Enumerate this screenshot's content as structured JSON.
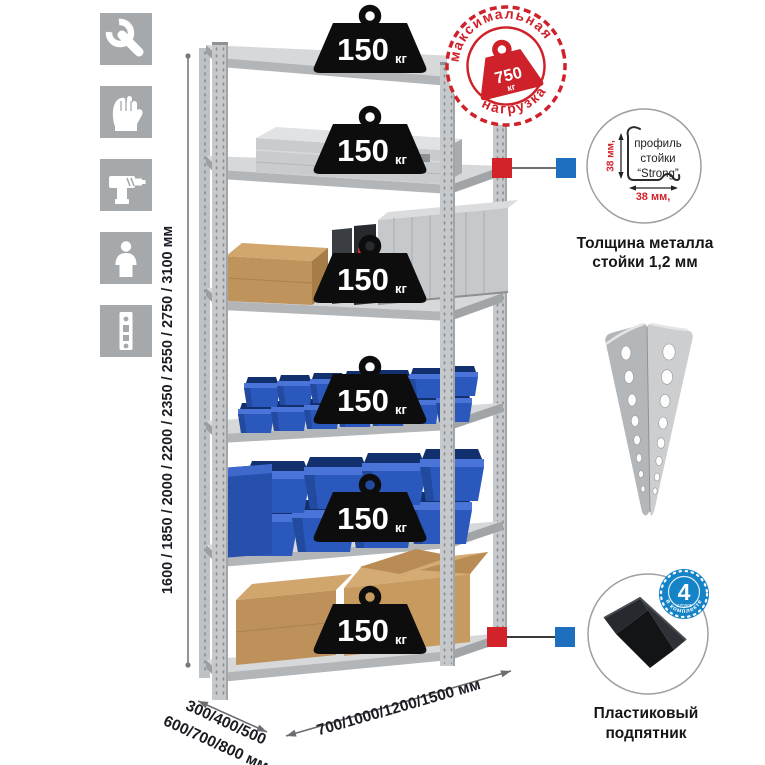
{
  "sidebar": {
    "icons": [
      "wrench-icon",
      "gloves-icon",
      "drill-icon",
      "person-icon",
      "rack-post-icon"
    ]
  },
  "stamp": {
    "arc_top": "максимальная",
    "arc_bottom": "нагрузка",
    "value": "750",
    "unit": "кг"
  },
  "shelves": [
    {
      "load": "150",
      "unit": "кг"
    },
    {
      "load": "150",
      "unit": "кг"
    },
    {
      "load": "150",
      "unit": "кг"
    },
    {
      "load": "150",
      "unit": "кг"
    },
    {
      "load": "150",
      "unit": "кг"
    },
    {
      "load": "150",
      "unit": "кг"
    }
  ],
  "dimensions": {
    "height": "1600 / 1850 / 2000 / 2200 / 2350 / 2550 / 2750 / 3100 мм",
    "depth_line1": "300/400/500",
    "depth_line2": "600/700/800 мм",
    "width": "700/1000/1200/1500 мм"
  },
  "profile_detail": {
    "label_line1": "профиль",
    "label_line2": "стойки",
    "label_line3": "“Strong”",
    "dim_vertical": "38 мм,",
    "dim_horizontal": "38 мм,",
    "caption_line1": "Толщина металла",
    "caption_line2": "стойки 1,2 мм"
  },
  "foot_detail": {
    "badge_value": "4",
    "badge_sub": "штуки",
    "badge_arc": "в комплекте",
    "caption_line1": "Пластиковый",
    "caption_line2": "подпятник"
  },
  "colors": {
    "accent_red": "#d2232b",
    "callout_blue": "#1f6fbf",
    "badge_blue": "#1583c7",
    "bin_blue": "#2b58bd",
    "metal_gray": "#c6c9cb",
    "icon_gray": "#a6a9ac",
    "text_dark": "#1b1b24"
  }
}
